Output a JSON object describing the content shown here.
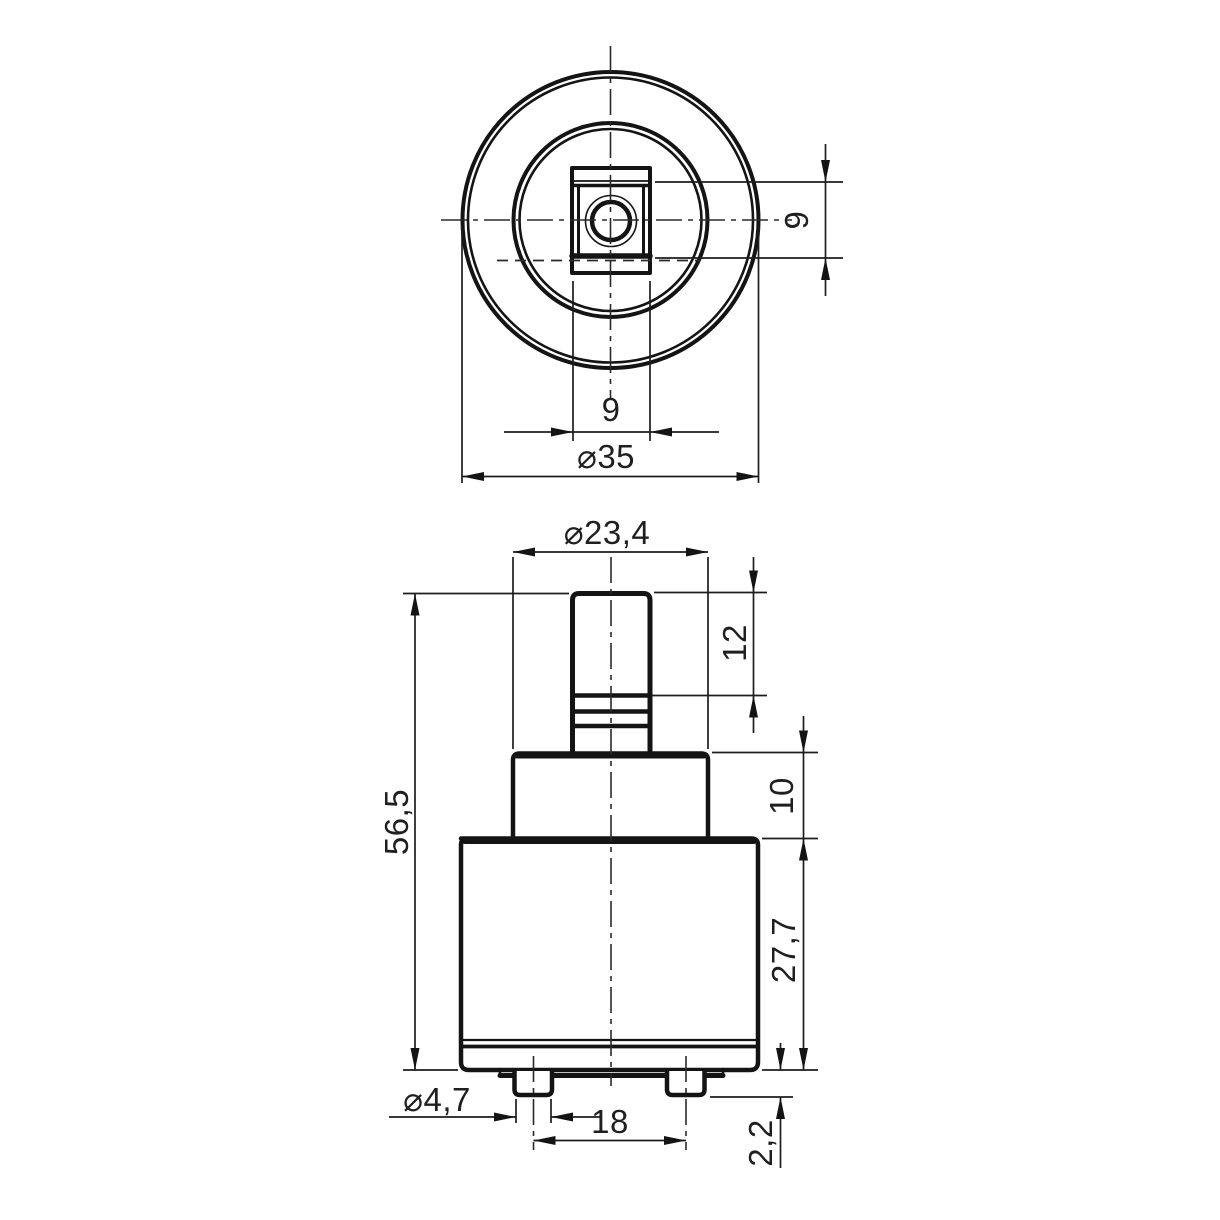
{
  "page": {
    "background": "#ffffff",
    "line_color": "#141414",
    "text_color": "#1f1f1f"
  },
  "drawing": {
    "type": "2-view orthographic technical drawing of a faucet cartridge",
    "units_style": "comma decimal separator",
    "top_view": {
      "square_width_label": "9",
      "square_height_label": "9",
      "outer_diameter_label": "⌀35"
    },
    "front_view": {
      "shoulder_diameter_label": "⌀23,4",
      "stem_height_label": "12",
      "shoulder_height_label": "10",
      "overall_height_label": "56,5",
      "body_height_label": "27,7",
      "tab_diameter_label": "⌀4,7",
      "tab_spacing_label": "18",
      "tab_protrusion_label": "2,2"
    }
  }
}
